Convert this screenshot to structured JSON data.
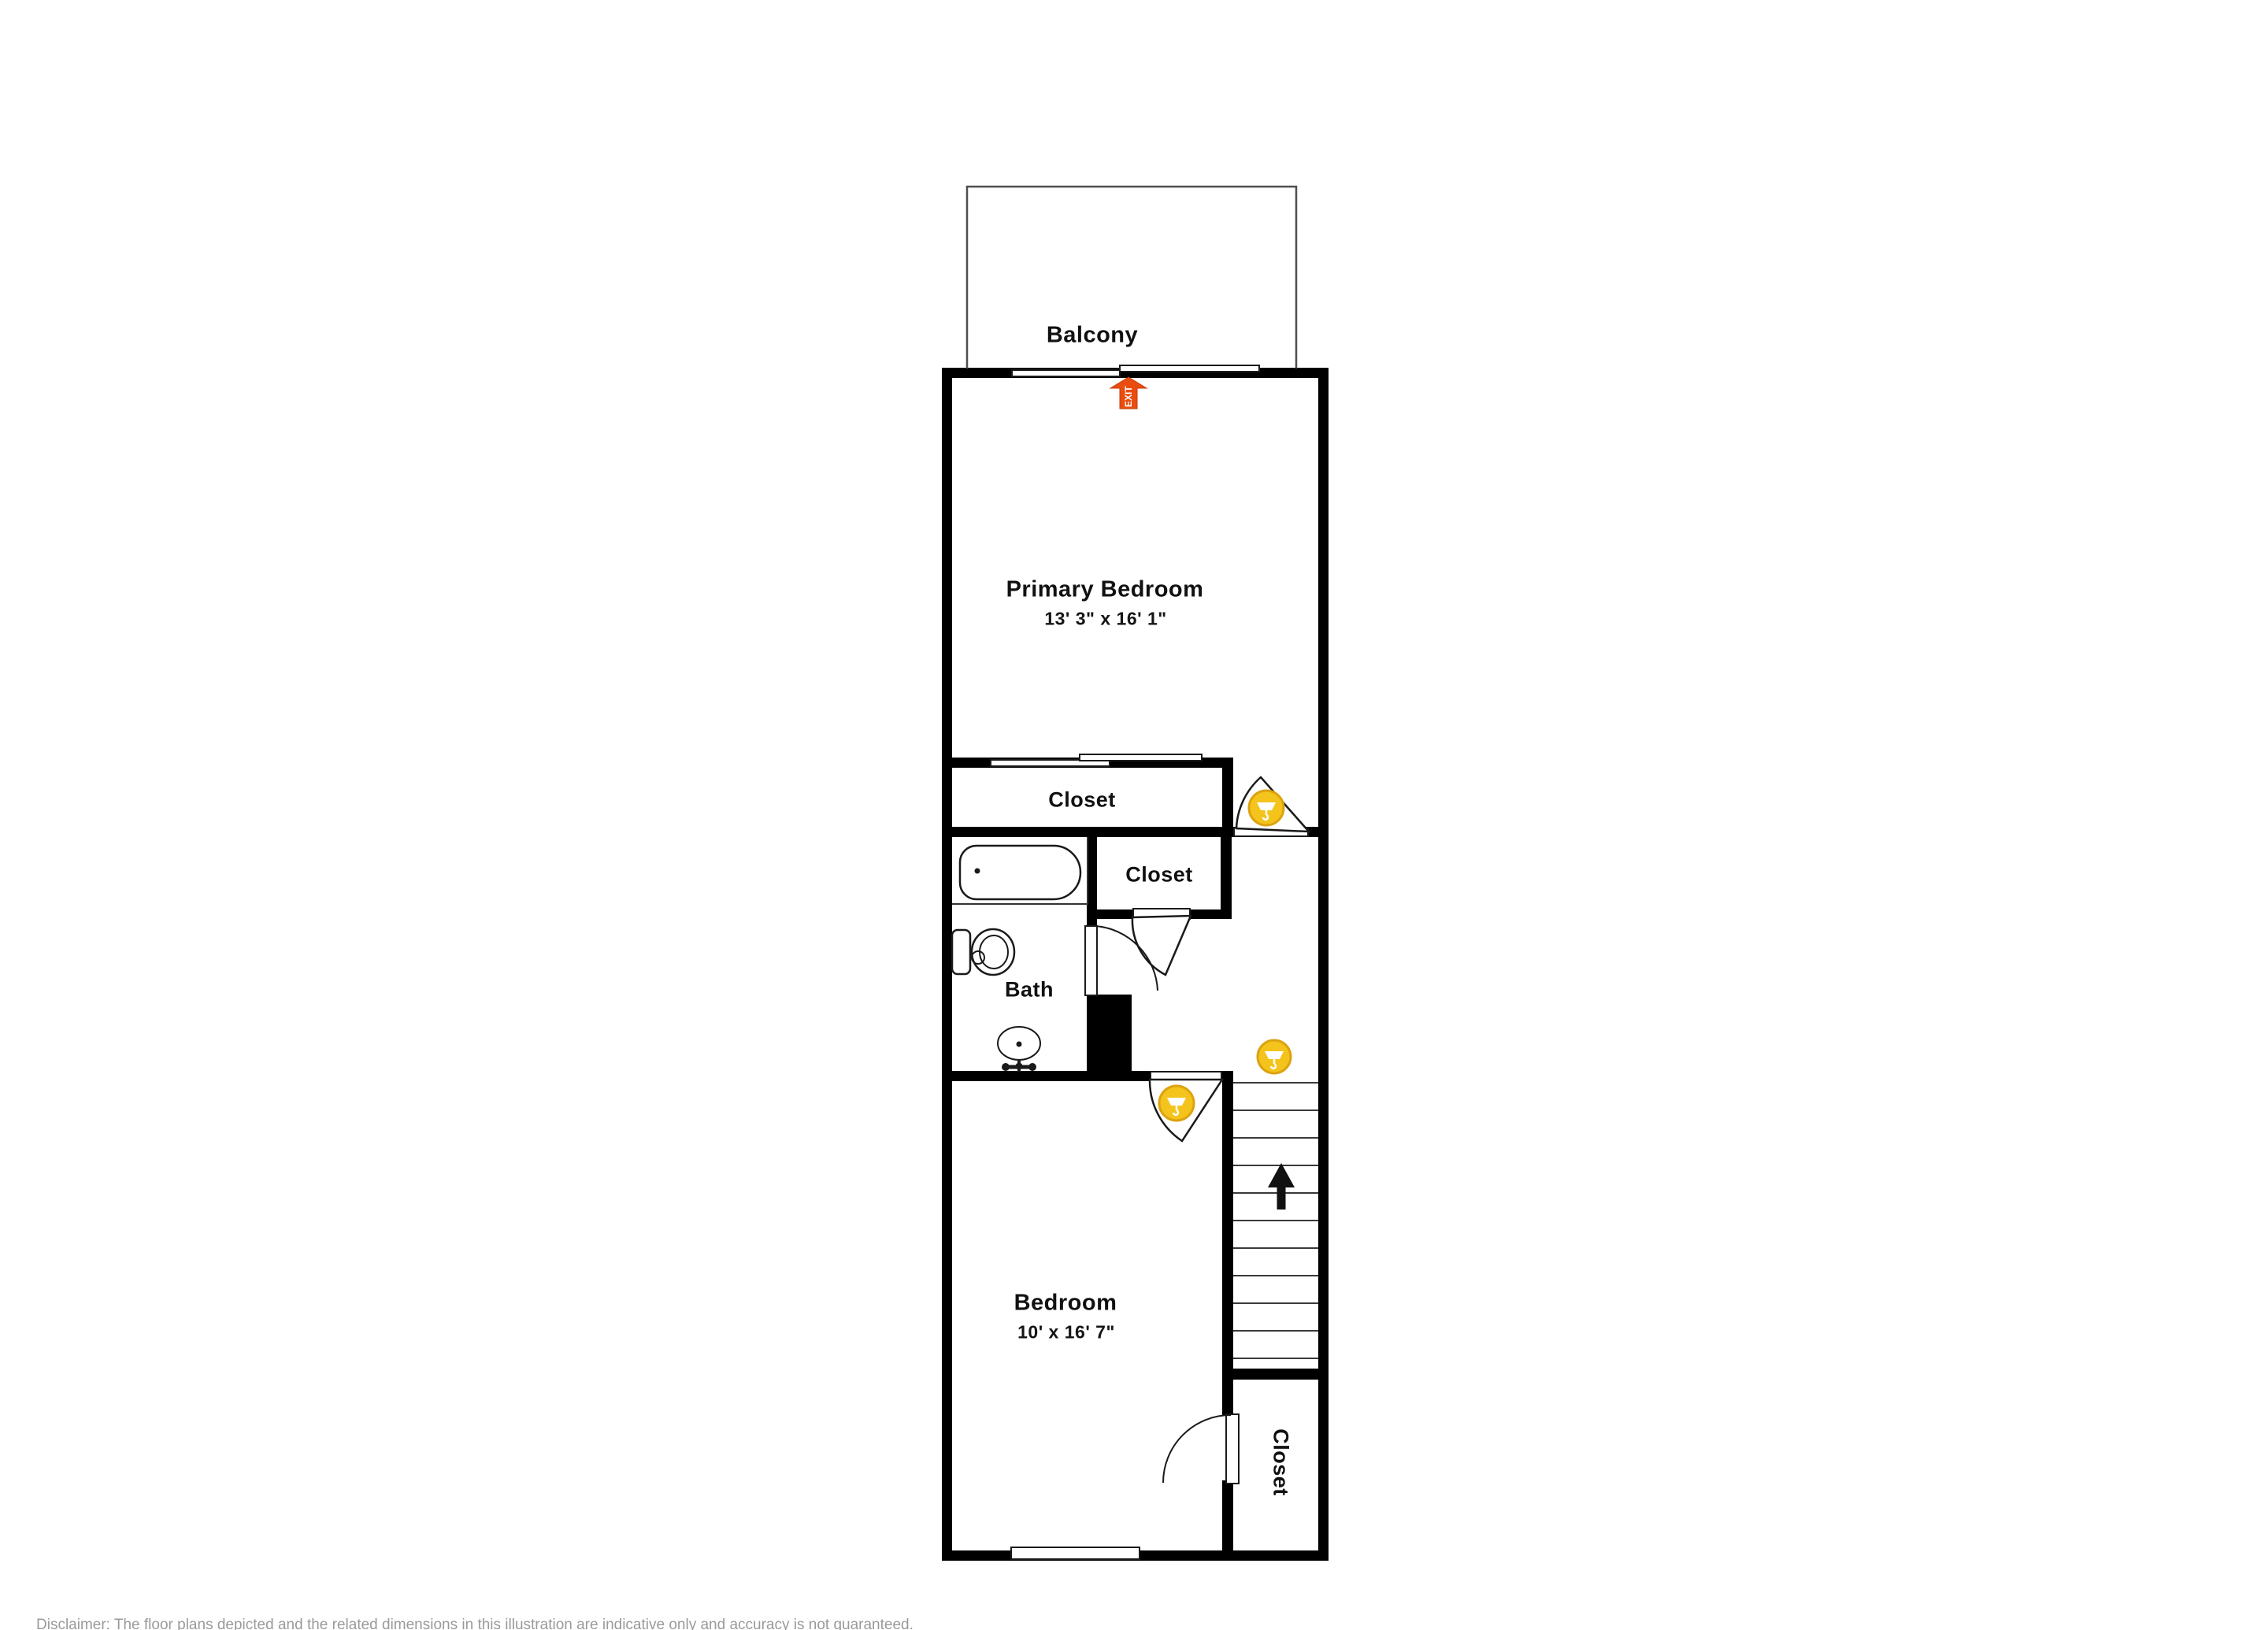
{
  "floorplan": {
    "balcony": {
      "label": "Balcony"
    },
    "primary_bedroom": {
      "label": "Primary Bedroom",
      "dimensions": "13' 3\" x 16' 1\""
    },
    "primary_closet": {
      "label": "Closet"
    },
    "hall_closet": {
      "label": "Closet"
    },
    "bath": {
      "label": "Bath"
    },
    "bedroom": {
      "label": "Bedroom",
      "dimensions": "10' x 16' 7\""
    },
    "bedroom_closet": {
      "label": "Closet"
    },
    "exit_marker": {
      "label": "EXIT",
      "color": "#E94D0F"
    },
    "stairs": {
      "direction": "up",
      "tread_count": 11
    },
    "tour_points": {
      "count": 3,
      "color": "#F4C31C"
    },
    "wall_color": "#000000"
  },
  "footer": {
    "disclaimer": "Disclaimer: The floor plans depicted and the related dimensions in this illustration are indicative only and accuracy is not guaranteed."
  }
}
